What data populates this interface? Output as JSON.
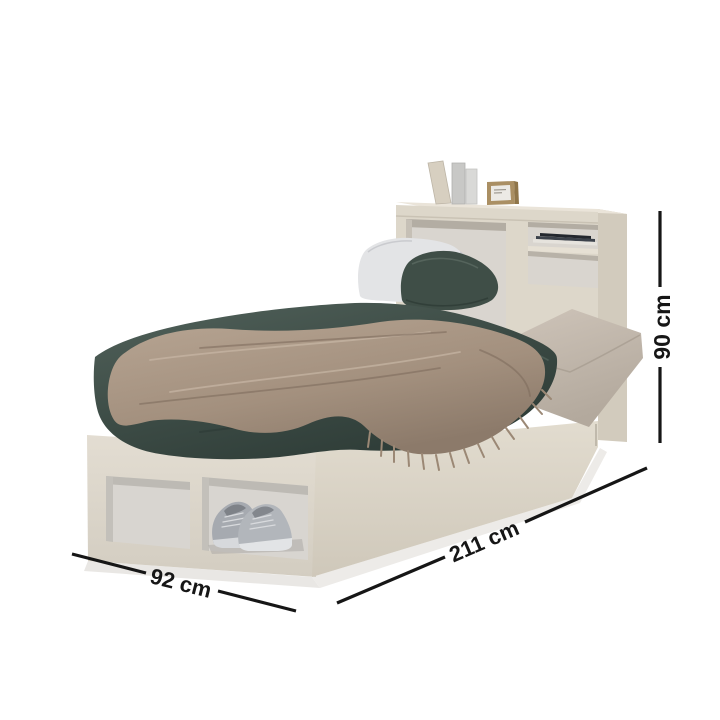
{
  "meta": {
    "image_type": "furniture product dimension diagram",
    "background": "#ffffff"
  },
  "product": {
    "name": "Single bed with bookcase headboard and under-bed storage cubbies",
    "scene_elements": [
      "bookcase headboard",
      "decor books on headboard top",
      "wooden picture frame",
      "stack of books on shelf",
      "white pillow",
      "dark green pillow",
      "greige mattress",
      "dark green duvet",
      "taupe fringed throw blanket",
      "open storage cubby (empty)",
      "open storage cubby with grey sneakers"
    ]
  },
  "dimensions": {
    "height": {
      "label": "90 cm",
      "orientation": "vertical-right"
    },
    "length": {
      "label": "211 cm",
      "orientation": "diagonal-lower-right"
    },
    "width": {
      "label": "92 cm",
      "orientation": "diagonal-lower-left"
    }
  },
  "colors": {
    "dimension_line": "#161616",
    "wood_light": "#ddd7ca",
    "wood_side": "#d2cbbd",
    "cubby_interior": "#d8d5d0",
    "duvet_green": "#3c4b45",
    "throw_taupe": "#a3907e",
    "pillow_white": "#e3e4e6",
    "pillow_green": "#3f4e47",
    "mattress_greige": "#c6bcb0",
    "sneaker_grey": "#b2b6bb"
  }
}
